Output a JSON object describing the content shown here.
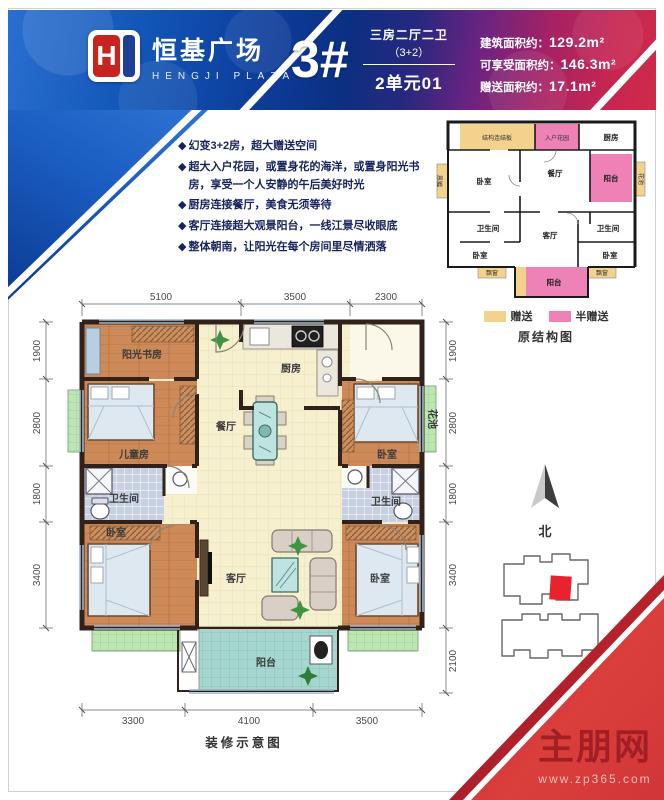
{
  "header": {
    "logo_letter": "H",
    "logo_cn": "恒基广场",
    "logo_en": "HENGJI PLAZA",
    "unit_number": "3#",
    "unit_type_line1": "三房二厅二卫",
    "unit_type_line2": "（3+2）",
    "unit_name": "2单元01",
    "stats": [
      {
        "label": "建筑面积约：",
        "value": "129.2m²"
      },
      {
        "label": "可享受面积约：",
        "value": "146.3m²"
      },
      {
        "label": "赠送面积约：",
        "value": "17.1m²"
      }
    ]
  },
  "features": {
    "bullet": "◆",
    "items": [
      "幻变3+2房，超大赠送空间",
      "超大入户花园，或置身花的海洋，或置身阳光书房，享受一个人安静的午后美好时光",
      "厨房连接餐厅，美食无须等待",
      "客厅连接超大观景阳台，一线江景尽收眼底",
      "整体朝南，让阳光在每个房间里尽情洒落"
    ]
  },
  "structure_diagram": {
    "caption": "原结构图",
    "legend": [
      {
        "label": "赠送",
        "color": "#f3d28e"
      },
      {
        "label": "半赠送",
        "color": "#ee82b6"
      }
    ],
    "rooms": {
      "link_board": "结构连结板",
      "entry_garden": "入户花园",
      "kitchen": "厨房",
      "bedroom_top": "卧室",
      "dining": "餐厅",
      "balcony_right": "阳台",
      "flower_right": "花池",
      "bay_left": "飘窗",
      "bath_left": "卫生间",
      "bath_right": "卫生间",
      "bedroom_left": "卧室",
      "living": "客厅",
      "bedroom_right": "卧室",
      "bay_bottom_left": "飘窗",
      "bay_bottom_right": "飘窗",
      "balcony_bottom": "阳台"
    }
  },
  "floor_plan": {
    "caption": "装修示意图",
    "dims_top": [
      "5100",
      "3500",
      "2300"
    ],
    "dims_bottom": [
      "3300",
      "4100",
      "3500"
    ],
    "dims_left": [
      "1900",
      "2800",
      "1800",
      "3400"
    ],
    "dims_right": [
      "1900",
      "2800",
      "1800",
      "3400",
      "2100"
    ],
    "rooms": {
      "study": "阳光书房",
      "kitchen": "厨房",
      "kids_room": "儿童房",
      "dining": "餐厅",
      "bedroom_mid_right": "卧室",
      "flower_box": "花池",
      "bath_left": "卫生间",
      "bath_right": "卫生间",
      "bedroom_bottom_left": "卧室",
      "living": "客厅",
      "bedroom_bottom_right": "卧室",
      "balcony": "阳台"
    }
  },
  "compass": {
    "label": "北"
  },
  "watermark": {
    "site_name": "主朋网",
    "site_url": "www.zp365.com"
  },
  "colors": {
    "header_blue": "#1257b8",
    "header_navy": "#0b2f82",
    "header_red": "#cf2b49",
    "gift_yellow": "#f3d28e",
    "half_gift_pink": "#ee82b6",
    "corner_red": "#d23538"
  }
}
